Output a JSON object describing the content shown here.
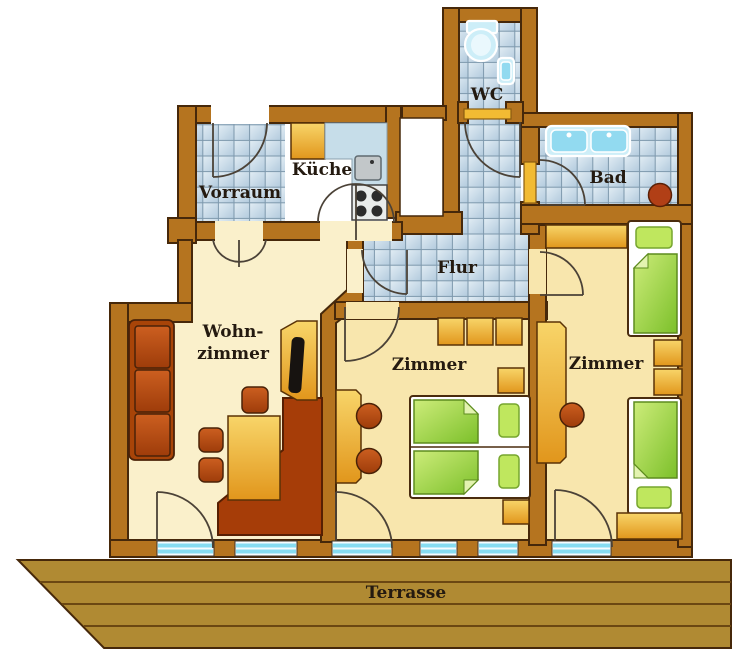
{
  "title": "Apartment floor plan",
  "rooms": {
    "vorraum": "Vorraum",
    "kueche": "Küche",
    "wc": "WC",
    "bad": "Bad",
    "flur": "Flur",
    "wohnzimmer_line1": "Wohn-",
    "wohnzimmer_line2": "zimmer",
    "zimmer_mitte": "Zimmer",
    "zimmer_rechts": "Zimmer",
    "terrasse": "Terrasse"
  },
  "colors": {
    "wall": "#b5741f",
    "wall_outline": "#46280a",
    "tile": "#c7d9e6",
    "tile_grout": "#7d98ac",
    "floor_living": "#faf0cb",
    "floor_bedroom": "#f8e6ad",
    "floor_kitchen": "#ffffff",
    "furniture_orange": "#e8a01e",
    "furniture_rust": "#b04a10",
    "bed_green": "#8cc63f",
    "fixture_blue": "#92daf0",
    "terrace_wood": "#b08a33",
    "window_blue": "#86dcf1",
    "label_text": "#241a10"
  }
}
